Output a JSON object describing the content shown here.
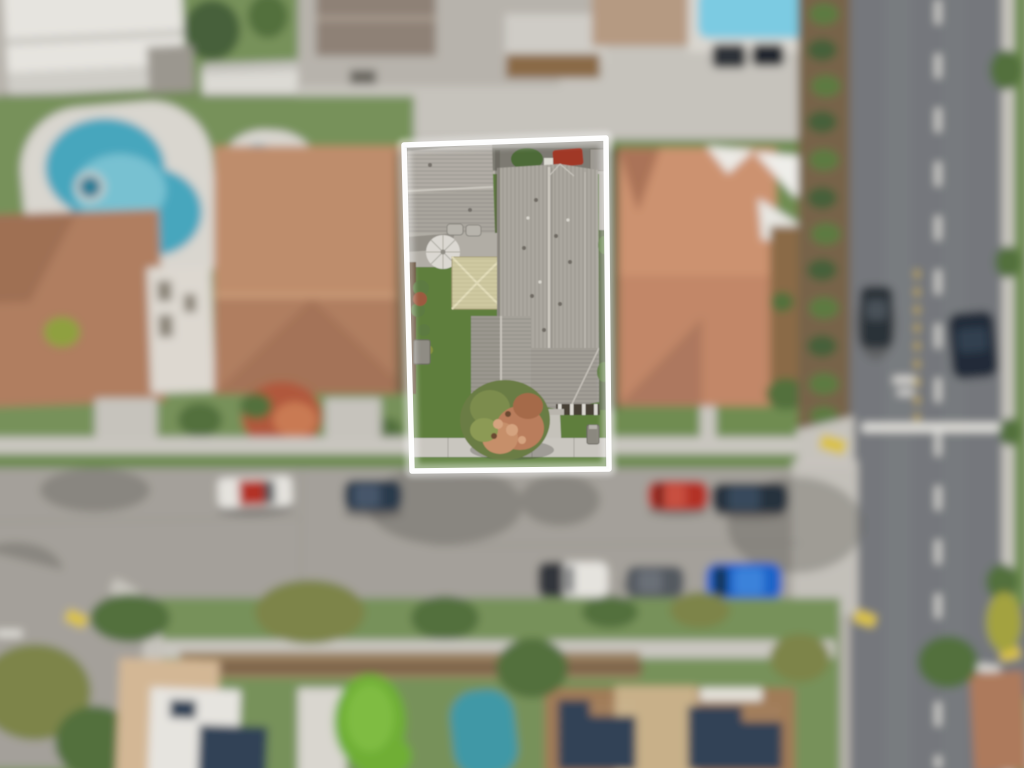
{
  "meta": {
    "title": "Aerial drone photo of a residential lot outlined in white",
    "description": "Overhead aerial photograph of a suburban block. The center property is in sharp focus and traced with a white boundary outline; surrounding houses, two backyard pools, streets with parked cars, a cross street, shade sails and solar-panel rooftops are all blurred.",
    "outline_color": "#ffffff"
  },
  "subject_property": {
    "features": [
      "detached-garage-gray-shingle-roof",
      "main-house-gray-shingle-roof",
      "front-wing-roof",
      "porch-roof-with-posts",
      "tan-shed-roof",
      "patio-umbrella",
      "rear-alley-strip-with-bins-and-red-car",
      "side-lawn-with-shrubs",
      "ac-unit",
      "front-lawn",
      "autumn-tree-green-and-pink",
      "front-walkway",
      "public-sidewalk",
      "parkway-strip",
      "mailbox"
    ]
  },
  "neighborhood": {
    "left": [
      "large-kidney-pool-with-spa",
      "small-kidney-pool",
      "terracotta-roof-house-a",
      "terracotta-roof-house-b",
      "red-front-yard-tree",
      "driveways"
    ],
    "right": [
      "salmon-tile-roof-house",
      "white-shade-sails",
      "wood-deck",
      "hedge-row"
    ],
    "top": [
      "white-gable-roof-building",
      "rv-trailer",
      "gray-shed",
      "rear-alley",
      "lap-pool-edge",
      "tan-roof",
      "two-dark-parked-cars",
      "planter-strip"
    ],
    "bottom": [
      "parkway-trees",
      "tan-house-with-solar-panels",
      "white-flat-roof",
      "paver-patio",
      "putting-green",
      "teal-pool",
      "brown-roof-house-with-solar-arrays",
      "terracotta-corner-house",
      "curb-ramps"
    ]
  },
  "streets": {
    "main_street_parked_cars": [
      "white-and-red-truck",
      "dark-blue-sedan",
      "red-coupe",
      "navy-sedan",
      "black-and-white-suv",
      "gray-sedan",
      "blue-sedan"
    ],
    "cross_street_cars": [
      "dark-suv-left-lane",
      "dark-suv-right-lane"
    ],
    "markings": [
      "white-center-dashes",
      "yellow-center-dashes",
      "white-stop-bar",
      "pavement-legend",
      "crosswalk-line",
      "yellow-curb-ramp-pads",
      "tree-shadows-on-asphalt"
    ]
  },
  "palette": {
    "concrete": "#b7b3ac",
    "concreteLight": "#c6c3bc",
    "sidewalk": "#c9c6bf",
    "asphaltMain": "#a4a09a",
    "asphaltCross": "#74777b",
    "grass": "#77915a",
    "grassDark": "#5d7a42",
    "lawn": "#5f7e3e",
    "parkway": "#6d8a50",
    "shingle": "#aba79f",
    "shingleDark": "#9b978f",
    "shedKhaki": "#cfc9a1",
    "terracotta": "#ad7a5b",
    "terracottaLight": "#bd8a68",
    "salmon": "#c08464",
    "salmonLight": "#cb8f6c",
    "poolWater": "#47a6bd",
    "poolLight": "#84c8d6",
    "poolDeck": "#d9d6cf",
    "poolTop": "#7ccbe2",
    "poolTeal": "#3f98a6",
    "treeGreen": "#53703c",
    "treeOlive": "#7d8448",
    "treeYellow": "#a3a23f",
    "treeRed": "#b0593c",
    "mulch": "#776449",
    "dirt": "#99805f",
    "fence": "#7b6248",
    "deckBrown": "#8a6a46",
    "solar": "#2c3c52",
    "whiteRoof": "#e6e4df",
    "whiteBldg": "#dcdad4",
    "tanWall": "#d3b795",
    "carRed": "#b23226",
    "carNavy": "#2c3a4c",
    "carBlue": "#1d64c8",
    "carGray": "#555a60",
    "carDark": "#2b3138",
    "carWhite": "#e5e3de",
    "padYellow": "#d9c14a",
    "markWhite": "#eceae4",
    "markYellow": "#d8b93e",
    "shadow": "#4e4b46",
    "outline": "#ffffff"
  }
}
